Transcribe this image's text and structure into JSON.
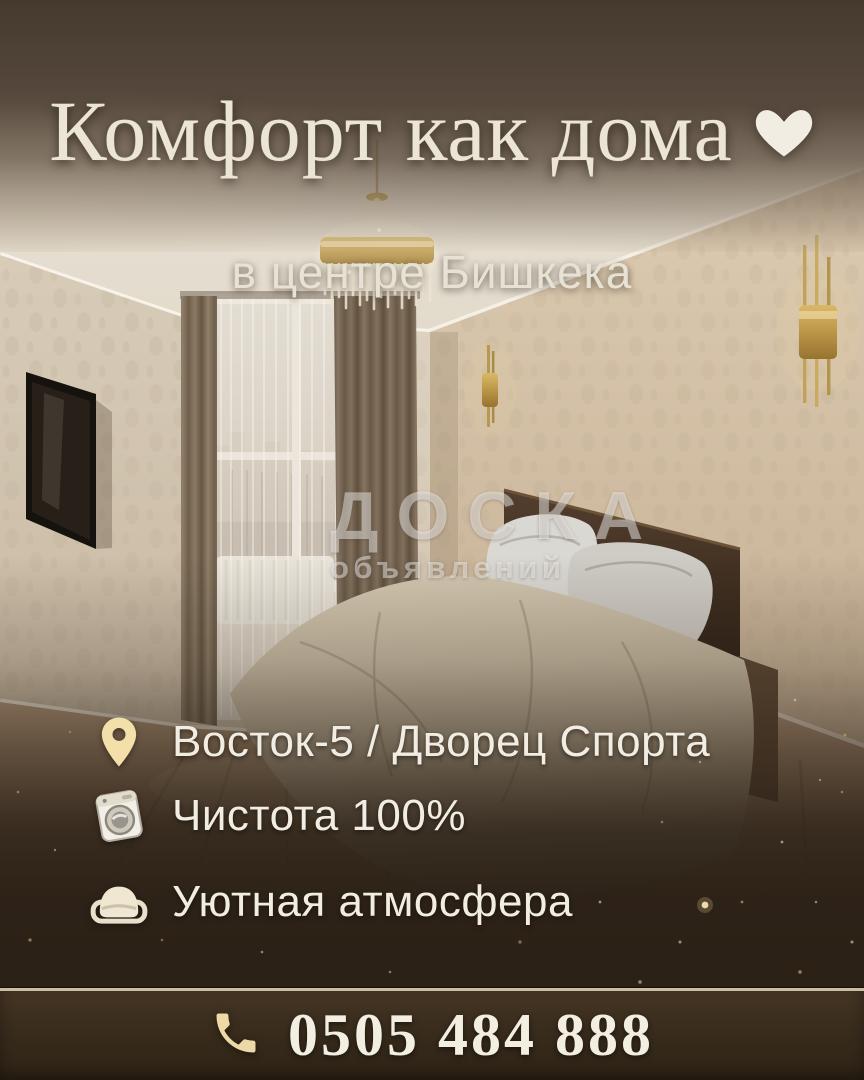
{
  "poster": {
    "title": "Комфорт как дома",
    "title_icon": "heart-icon",
    "subtitle": "в центре Бишкека",
    "watermark": {
      "line1": "ДОСКА",
      "line2": "объявлений"
    },
    "scene_description": "bedroom-photo",
    "features": [
      {
        "icon": "location-pin-icon",
        "label": "Восток-5 / Дворец Спорта"
      },
      {
        "icon": "washing-machine-icon",
        "label": "Чистота 100%"
      },
      {
        "icon": "bed-icon",
        "label": "Уютная атмосфера"
      }
    ],
    "phone": {
      "icon": "phone-handset-icon",
      "number": "0505 484 888"
    },
    "colors": {
      "title_text": "#ece5d6",
      "subtitle_text": "#e8e2d5",
      "feature_text": "#f2ede3",
      "phone_text": "#f3eee2",
      "icon_gold": "#f3dfa9",
      "heart_white": "#f1ede2",
      "watermark_white": "rgba(255,255,255,0.44)",
      "background_brown_dark": "#2d2217",
      "phone_bar_brown": "#3a2d1e",
      "separator_gold": "#d8cbac",
      "sparkle_gold": "#e6c386"
    }
  }
}
